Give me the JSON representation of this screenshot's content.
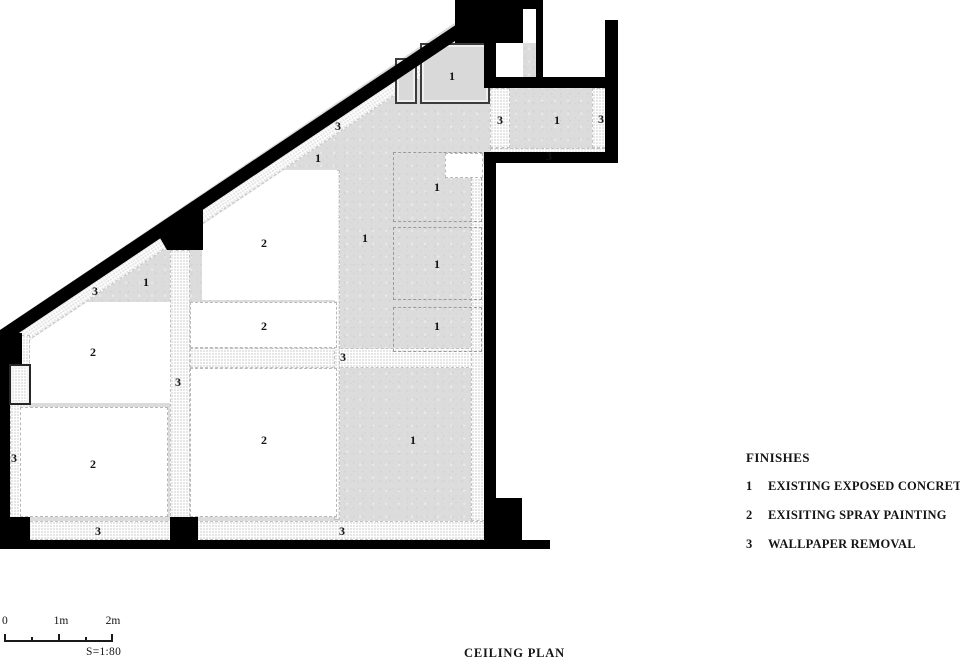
{
  "drawing": {
    "title": "CEILING PLAN"
  },
  "legend": {
    "title": "FINISHES",
    "items": [
      {
        "num": "1",
        "label": "EXISTING EXPOSED CONCRETE"
      },
      {
        "num": "2",
        "label": "EXISITING SPRAY PAINTING"
      },
      {
        "num": "3",
        "label": "WALLPAPER REMOVAL"
      }
    ]
  },
  "scalebar": {
    "tick_labels": [
      "0",
      "1m",
      "2m"
    ],
    "ratio": "S=1:80"
  },
  "colors": {
    "wall": "#000000",
    "concrete": "#dcdcdc",
    "hatch": "#e6e6e6",
    "room": "#ffffff"
  },
  "plan": {
    "markers": [
      {
        "t": "1",
        "x": 452,
        "y": 76
      },
      {
        "t": "3",
        "x": 338,
        "y": 126
      },
      {
        "t": "3",
        "x": 500,
        "y": 120
      },
      {
        "t": "1",
        "x": 557,
        "y": 120
      },
      {
        "t": "3",
        "x": 601,
        "y": 119
      },
      {
        "t": "3",
        "x": 549,
        "y": 156
      },
      {
        "t": "1",
        "x": 318,
        "y": 158
      },
      {
        "t": "1",
        "x": 437,
        "y": 187
      },
      {
        "t": "1",
        "x": 365,
        "y": 238
      },
      {
        "t": "2",
        "x": 264,
        "y": 243
      },
      {
        "t": "1",
        "x": 437,
        "y": 264
      },
      {
        "t": "1",
        "x": 146,
        "y": 282
      },
      {
        "t": "3",
        "x": 95,
        "y": 291
      },
      {
        "t": "2",
        "x": 264,
        "y": 326
      },
      {
        "t": "1",
        "x": 437,
        "y": 326
      },
      {
        "t": "2",
        "x": 93,
        "y": 352
      },
      {
        "t": "3",
        "x": 343,
        "y": 357
      },
      {
        "t": "3",
        "x": 178,
        "y": 382
      },
      {
        "t": "2",
        "x": 264,
        "y": 440
      },
      {
        "t": "1",
        "x": 413,
        "y": 440
      },
      {
        "t": "3",
        "x": 14,
        "y": 458
      },
      {
        "t": "2",
        "x": 93,
        "y": 464
      },
      {
        "t": "3",
        "x": 98,
        "y": 531
      },
      {
        "t": "3",
        "x": 342,
        "y": 531
      }
    ]
  }
}
